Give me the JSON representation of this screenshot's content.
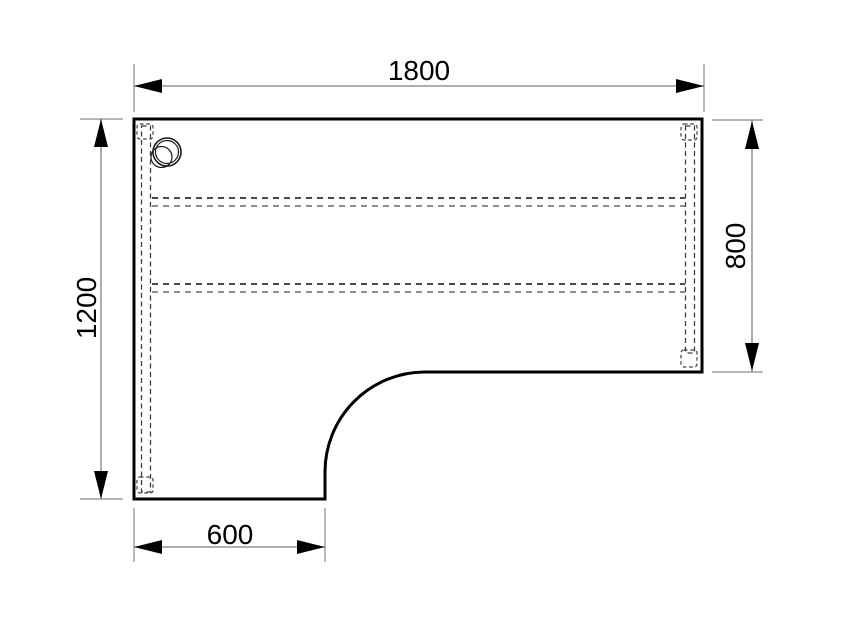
{
  "drawing": {
    "type": "technical-plan-diagram",
    "subject": "l-shaped-desk-top",
    "dimensions": {
      "top_width": {
        "label": "1800"
      },
      "left_height": {
        "label": "1200"
      },
      "right_height": {
        "label": "800"
      },
      "return_width": {
        "label": "600"
      }
    },
    "colors": {
      "background": "#ffffff",
      "outline": "#000000",
      "dimension_line": "#7f7f7f",
      "extension_line": "#8a8a8a",
      "arrow": "#000000",
      "label_text": "#000000",
      "hidden_line_dark": "#4a4a4a",
      "hidden_line_light": "#8f8f8f"
    }
  }
}
